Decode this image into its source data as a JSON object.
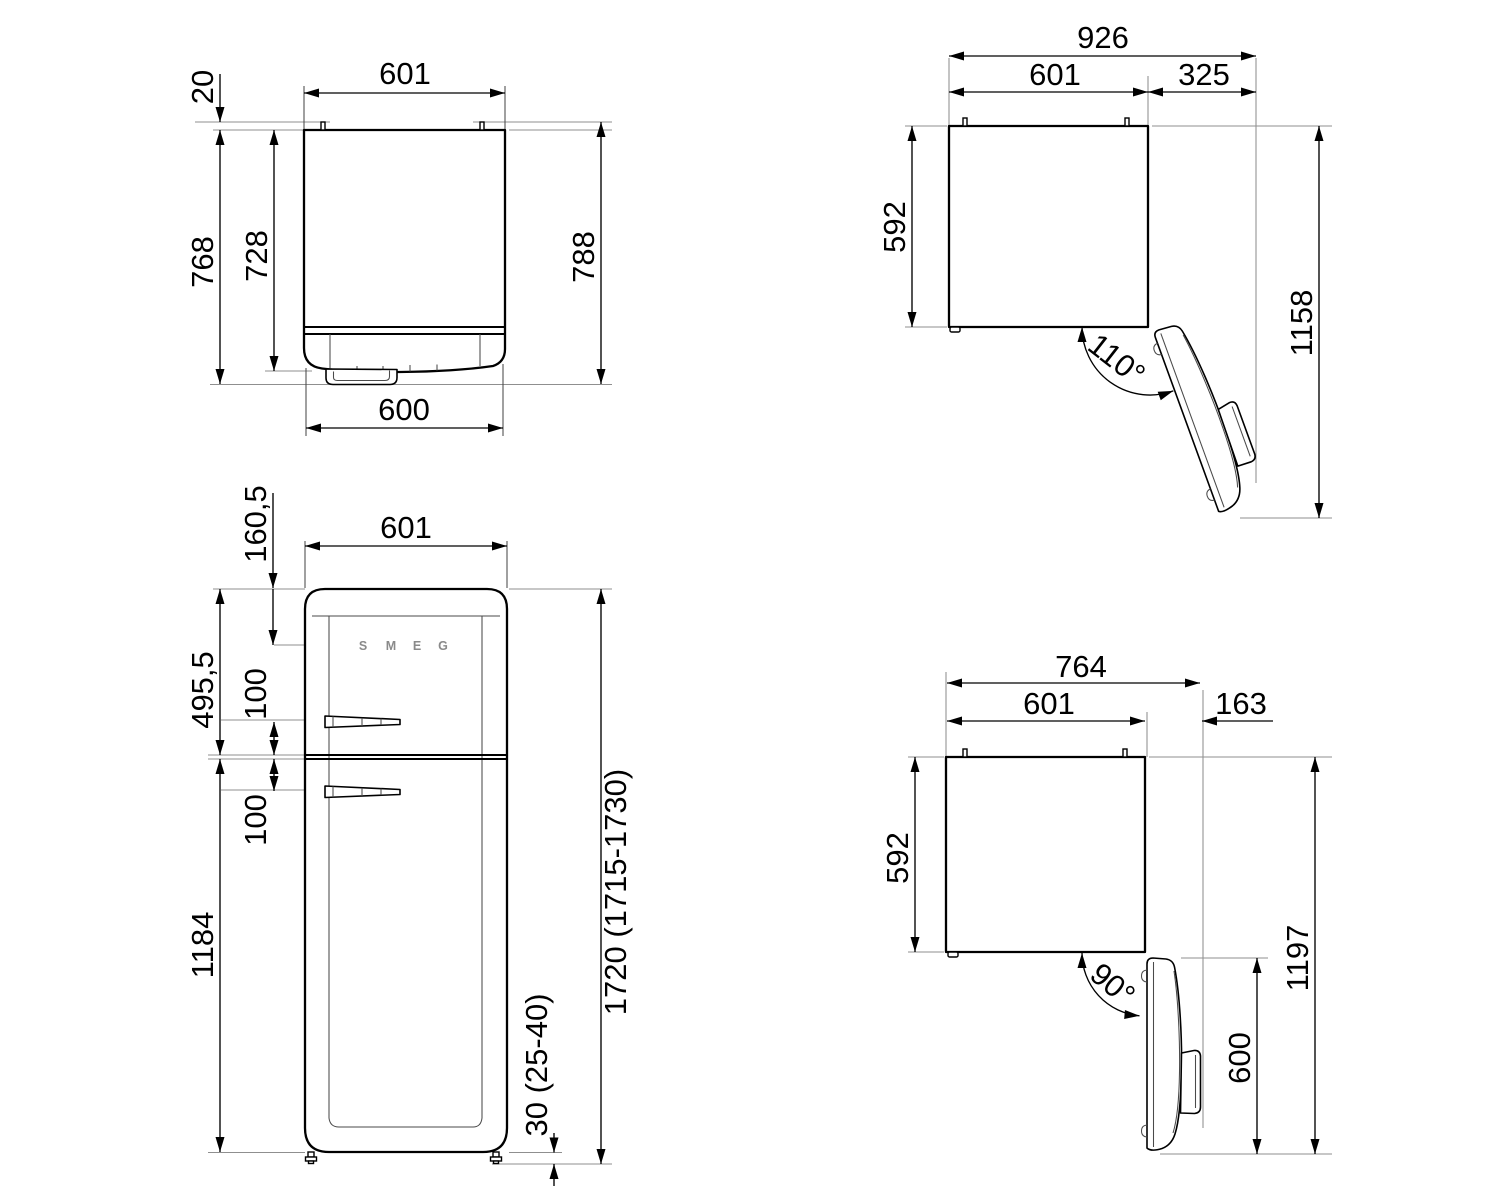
{
  "drawing": {
    "background": "#ffffff",
    "line_color": "#000000",
    "extension_line_color": "#8f8f8f",
    "brand_logo": [
      "S",
      "M",
      "E",
      "G"
    ],
    "views": {
      "top_closed": {
        "dims": {
          "pin_height": "20",
          "width": "601",
          "depth_body": "768",
          "depth_door": "728",
          "depth_total": "788",
          "door_width": "600"
        }
      },
      "top_open_110": {
        "dims": {
          "total_width": "926",
          "body_width": "601",
          "door_clearance": "325",
          "body_depth": "592",
          "total_depth": "1158",
          "angle": "110°"
        }
      },
      "front": {
        "dims": {
          "width": "601",
          "logo_from_top": "160,5",
          "freezer_section": "495,5",
          "handle_offset_upper": "100",
          "handle_offset_lower": "100",
          "fridge_section": "1184",
          "total_height": "1720 (1715-1730)",
          "feet_height": "30 (25-40)"
        }
      },
      "top_open_90": {
        "dims": {
          "total_width": "764",
          "body_width": "601",
          "door_clearance": "163",
          "body_depth": "592",
          "total_depth": "1197",
          "door_width": "600",
          "angle": "90°"
        }
      }
    }
  }
}
